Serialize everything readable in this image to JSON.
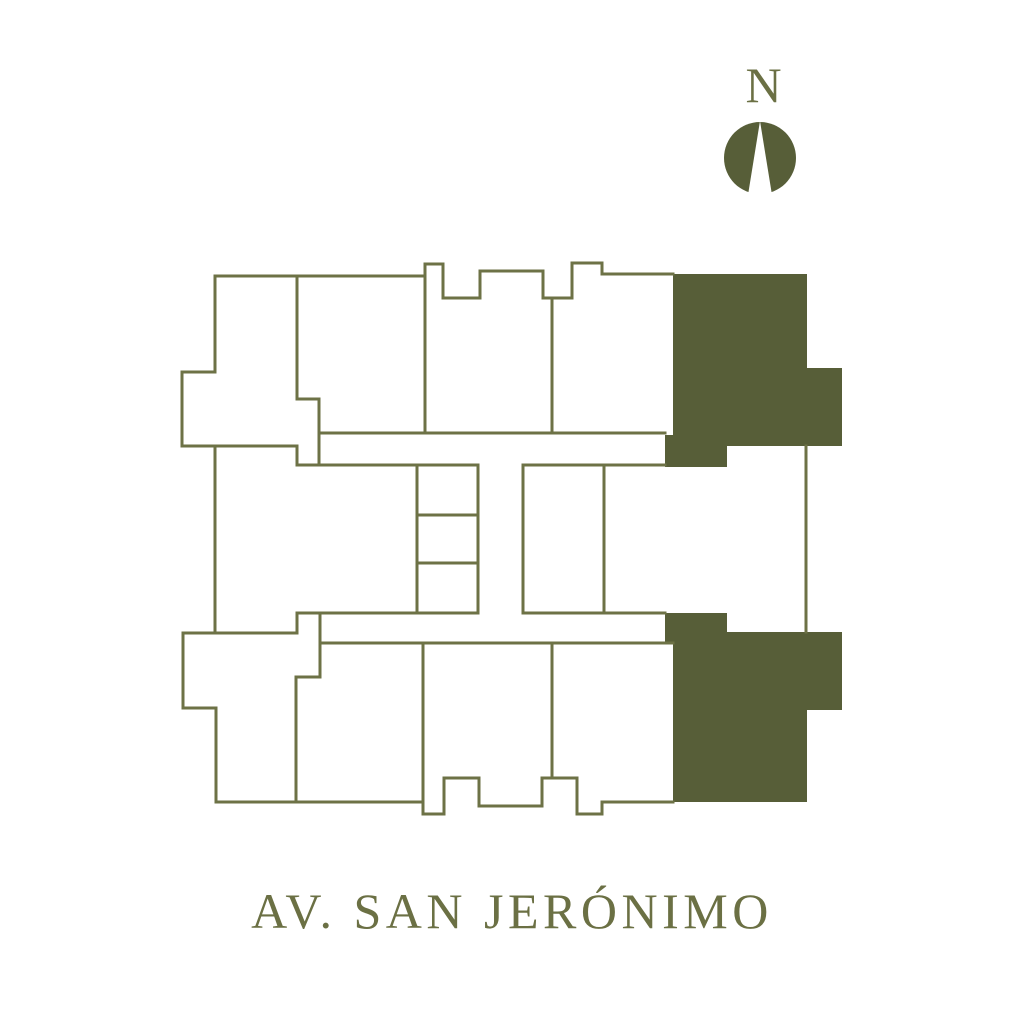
{
  "page": {
    "background_color": "#ffffff"
  },
  "compass": {
    "label": "N",
    "label_color": "#6b7044",
    "circle_color": "#575e38",
    "needle_color": "#ffffff",
    "cx": 760,
    "cy": 158,
    "r": 36,
    "needle_points": "760,121 748,195 772,195"
  },
  "street_label": {
    "text": "AV. SAN JERÓNIMO",
    "color": "#6b7044"
  },
  "floor_plan": {
    "line_color": "#6d7246",
    "highlight_color": "#575e38",
    "stroke_width": 3,
    "wall_paths": [
      "M215,276 H425 V264 H443 V298 H480 V271 H543 V298 H572 V263 H602 V274 H673",
      "M215,276 V372 H182 V446 H297 V465",
      "M215,446 V633",
      "M297,276 V399 H319 V465",
      "M425,264 V433",
      "M552,298 V433",
      "M319,433 H665",
      "M297,465 H478",
      "M523,465 H665",
      "M417,465 V613",
      "M478,465 V613",
      "M417,515 H478",
      "M417,563 H478",
      "M523,465 V613",
      "M604,465 V613",
      "M806,446 V632",
      "M297,613 H478",
      "M523,613 H665",
      "M320,643 H673",
      "M297,613 V633",
      "M183,633 H297",
      "M183,633 V708 H216 V802",
      "M320,613 V677 H296 V802",
      "M216,802 H423 V814 H444 V778 H479 V806 H542 V778 H577 V814 H602 V802 H673",
      "M423,643 V802",
      "M552,643 V778"
    ],
    "highlight_units": [
      {
        "name": "highlight-unit-top-right",
        "path": "M673,274 H807 V368 H842 V446 H727 V467 H665 V435 H673 Z"
      },
      {
        "name": "highlight-unit-bottom-right",
        "path": "M673,802 H807 V710 H842 V632 H727 V613 H665 V643 H673 Z"
      }
    ]
  }
}
